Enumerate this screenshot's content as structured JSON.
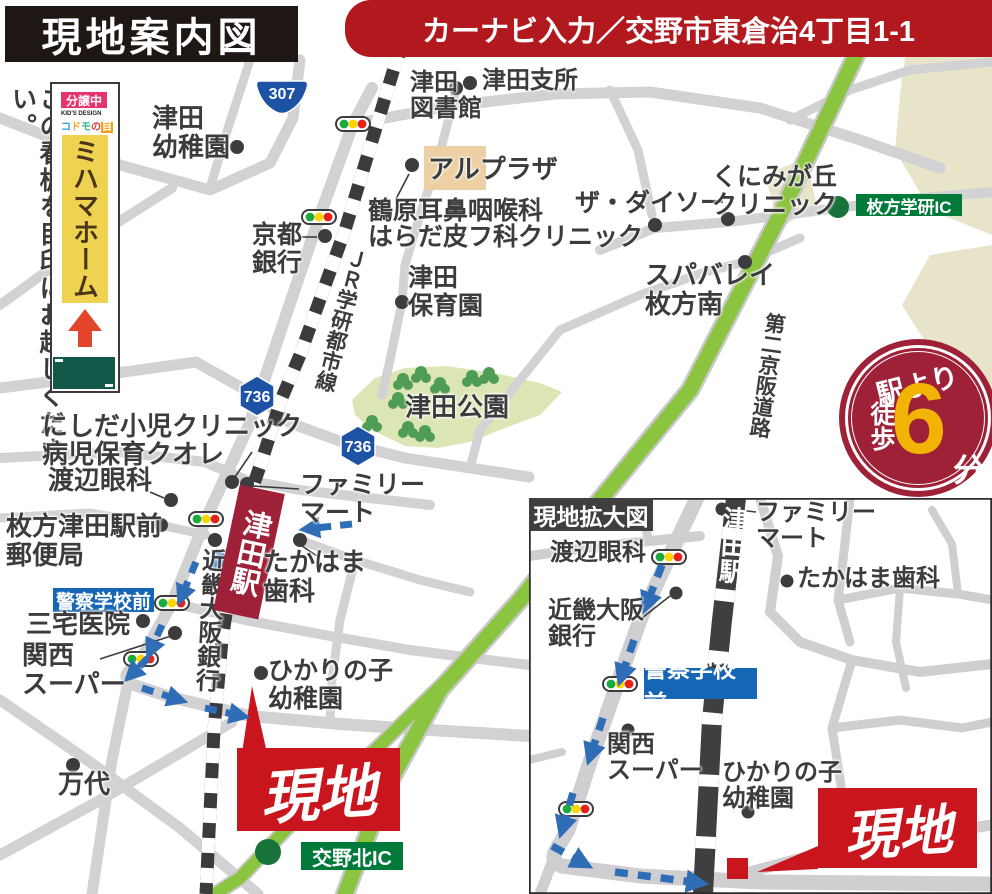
{
  "header": {
    "title": "現地案内図",
    "car_navi": "カーナビ入力／交野市東倉治4丁目1-1"
  },
  "signboard": {
    "caption": "この看板を目印にお越しください。",
    "status_badge": "分譲中",
    "kids_design": "KID'S DESIGN",
    "logo_chars": [
      "コ",
      "ド",
      "モ",
      "の",
      "目"
    ],
    "company": "ミハマホーム"
  },
  "walk_badge": {
    "from": "駅より",
    "walk": "徒歩",
    "minutes": "6",
    "unit": "分"
  },
  "main_map": {
    "rail_line": "ＪＲ学研都市線",
    "station": "津田駅",
    "expressway": "第二京阪道路",
    "site_label": "現地",
    "route_shields": {
      "national": "307",
      "prefectural": "736"
    },
    "ic_gakken": "枚方学研IC",
    "ic_katano": "交野北IC",
    "bus_stop_police": "警察学校前",
    "pois": {
      "tsuda_kindergarten": "津田\n幼稚園",
      "tsuda_library": "津田\n図書館",
      "tsuda_branch_office": "津田支所",
      "al_plaza": "アルプラザ",
      "tsuruhara_ent": "鶴原耳鼻咽喉科",
      "harada_derma": "はらだ皮フ科クリニック",
      "the_daiso": "ザ・ダイソー",
      "kunimigaoka_clinic": "くにみが丘\nクリニック",
      "spa_valley": "スパバレイ\n枚方南",
      "kyoto_bank": "京都\n銀行",
      "tsuda_nursery": "津田\n保育園",
      "tsuda_park": "津田公園",
      "nishida_clinic": "にしだ小児クリニック",
      "byoji_hoiku_cuore": "病児保育クオレ",
      "watanabe_eye": "渡辺眼科",
      "hirakata_tsuda_post": "枚方津田駅前\n郵便局",
      "miyake_clinic": "三宅医院",
      "kansai_super": "関西\nスーパー",
      "kinki_osaka_bank": "近畿大阪銀行",
      "family_mart": "ファミリー\nマート",
      "takahama_dental": "たかはま\n歯科",
      "hikarinoko_kindergarten": "ひかりの子\n幼稚園",
      "mandai": "万代"
    }
  },
  "inset": {
    "title": "現地拡大図",
    "station": "津田駅",
    "site_label": "現地",
    "bus_stop_police": "警察学校前",
    "pois": {
      "watanabe_eye": "渡辺眼科",
      "kinki_osaka_bank": "近畿大阪\n銀行",
      "kansai_super": "関西\nスーパー",
      "family_mart": "ファミリー\nマート",
      "takahama_dental": "たかはま歯科",
      "hikarinoko_kindergarten": "ひかりの子\n幼稚園"
    }
  },
  "colors": {
    "header_red": "#b2191f",
    "site_red": "#c9161e",
    "wine_red": "#9f2137",
    "expressway_green": "#8bc43e",
    "ic_green": "#007a3b",
    "route_blue": "#2f6eb6",
    "badge_blue": "#1566b4",
    "shield_blue": "#1d52a5",
    "road_gray": "#d2d2d4",
    "rail_dark": "#3b3b3d",
    "park_green": "#dce6b5",
    "sign_yellow": "#efd350",
    "status_pink": "#e6336e"
  }
}
